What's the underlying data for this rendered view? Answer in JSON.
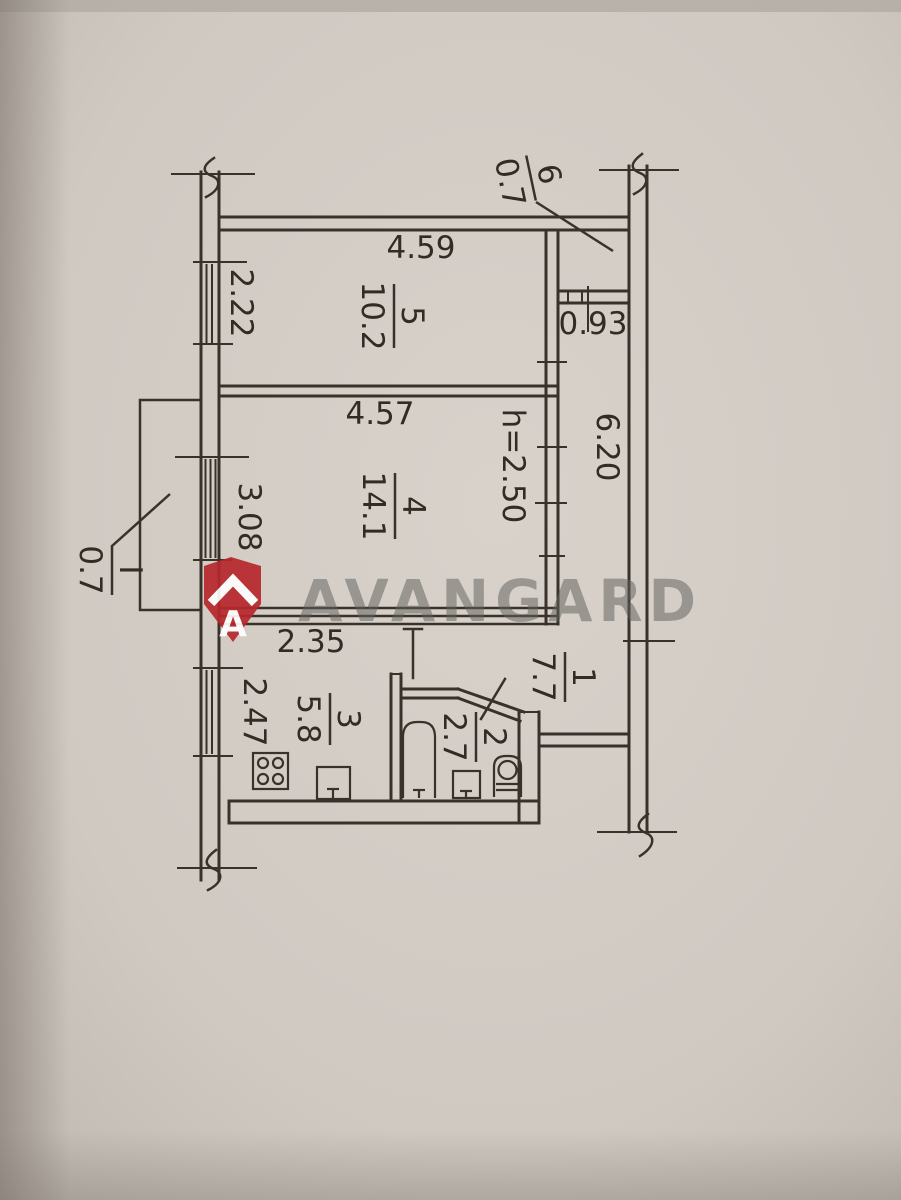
{
  "plan_title": "apartment-floor-plan",
  "rooms": {
    "room5": {
      "number": "5",
      "area": "10.2"
    },
    "room4": {
      "number": "4",
      "area": "14.1"
    },
    "room3": {
      "number": "3",
      "area": "5.8"
    },
    "room2": {
      "number": "2",
      "area": "2.7"
    },
    "room1": {
      "number": "1",
      "area": "7.7"
    },
    "room6": {
      "number": "6",
      "area": "0.7"
    },
    "balcony": {
      "number": "I",
      "area": "0.7"
    }
  },
  "dimensions": {
    "room5_width": "4.59",
    "room5_window": "2.22",
    "closet_width": "0.93",
    "hall_length": "6.20",
    "room4_width": "4.57",
    "room4_window": "3.08",
    "ceiling_height": "h=2.50",
    "kitchen_width": "2.35",
    "kitchen_window": "2.47"
  },
  "watermark": {
    "brand": "AVANGARD",
    "logo_letter": "A"
  },
  "colors": {
    "paper": "#d3ccc5",
    "ink": "#39322b",
    "watermark_red": "#b7282c",
    "watermark_gray": "#63625e"
  }
}
